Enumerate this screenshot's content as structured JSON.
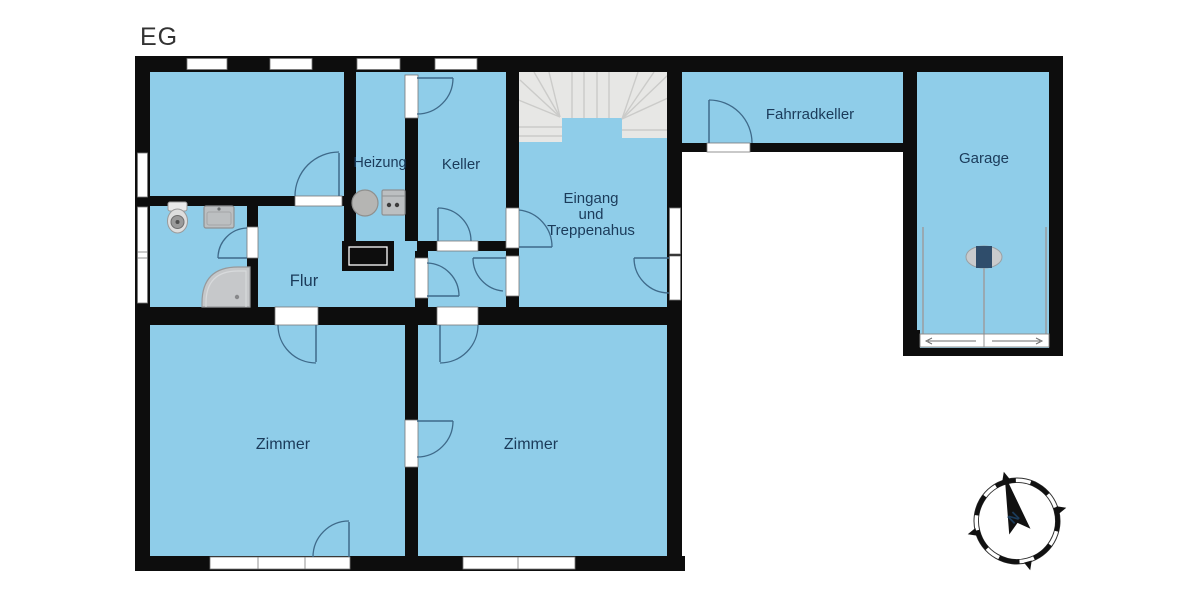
{
  "title": "EG",
  "rooms": {
    "heizung": "Heizung",
    "keller": "Keller",
    "eingang": {
      "line1": "Eingang",
      "line2": "und",
      "line3": "Treppenahus"
    },
    "fahrradkeller": "Fahrradkeller",
    "garage": "Garage",
    "flur": "Flur",
    "zimmer_left": "Zimmer",
    "zimmer_right": "Zimmer"
  },
  "compass": {
    "north_label": "N"
  },
  "colors": {
    "room-fill": "#8fcde9",
    "wall": "#0d0d0d",
    "label-text": "#1b3b5a",
    "stairs-fill": "#e7e7e5",
    "fixture-fill": "#bcbfc1",
    "fixture-stroke": "#8e9193",
    "door-arc": "#3f6a8a",
    "title-text": "#333333"
  }
}
